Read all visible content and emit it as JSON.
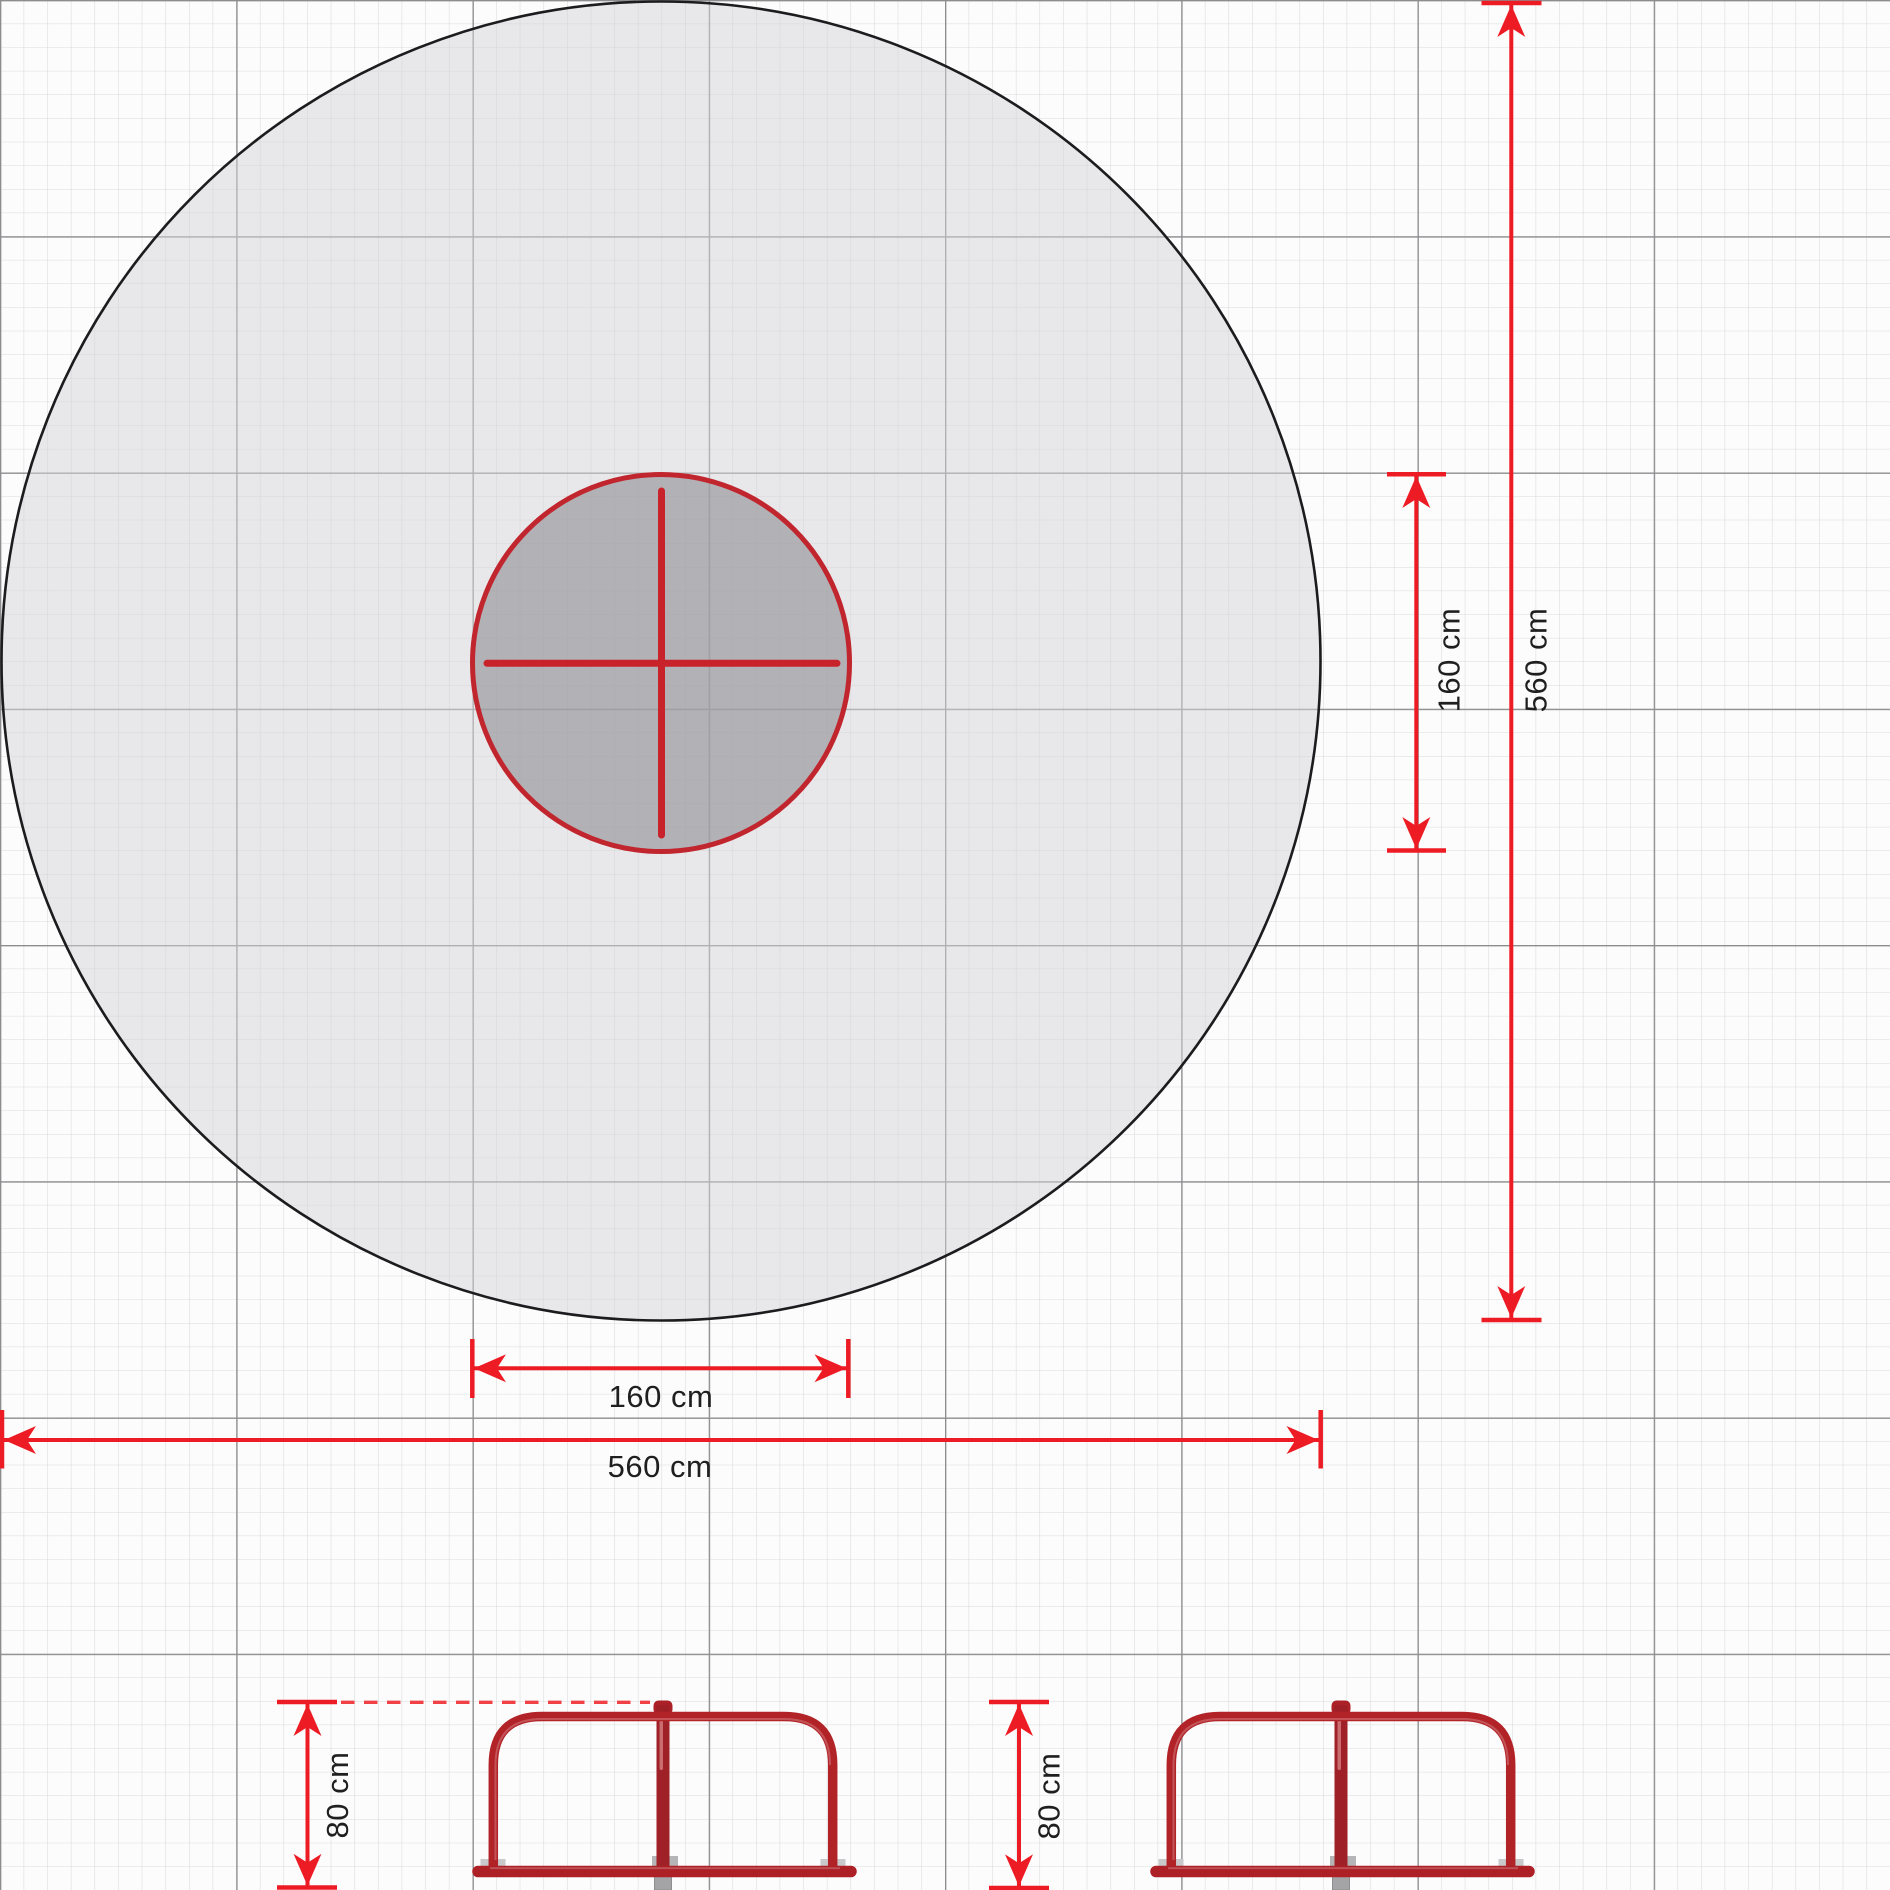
{
  "document": {
    "title": "Playground carousel technical drawing with safety zone"
  },
  "units": "cm",
  "plan_view": {
    "equipment_diameter_h_label": "160 cm",
    "safety_zone_diameter_h_label": "560 cm",
    "equipment_diameter_v_label": "160 cm",
    "safety_zone_diameter_v_label": "560 cm"
  },
  "side_views": {
    "left_height_label": "80 cm",
    "right_height_label": "80 cm"
  },
  "colors": {
    "dimension_red": "#ed1c24",
    "dashed_reference_red": "#ef4146",
    "equipment_red": "#b22328",
    "equipment_dark_red": "#9f2026",
    "carousel_cross_red": "#c8232b",
    "inner_circle_outline_red": "#c1262e",
    "safety_zone_fill": "#e9e9ea",
    "equipment_zone_fill": "#b1b0b4",
    "grid_minor": "#dadadb",
    "grid_major": "#8d8d8f",
    "ground_anchor_gray": "#a4a4a6"
  }
}
